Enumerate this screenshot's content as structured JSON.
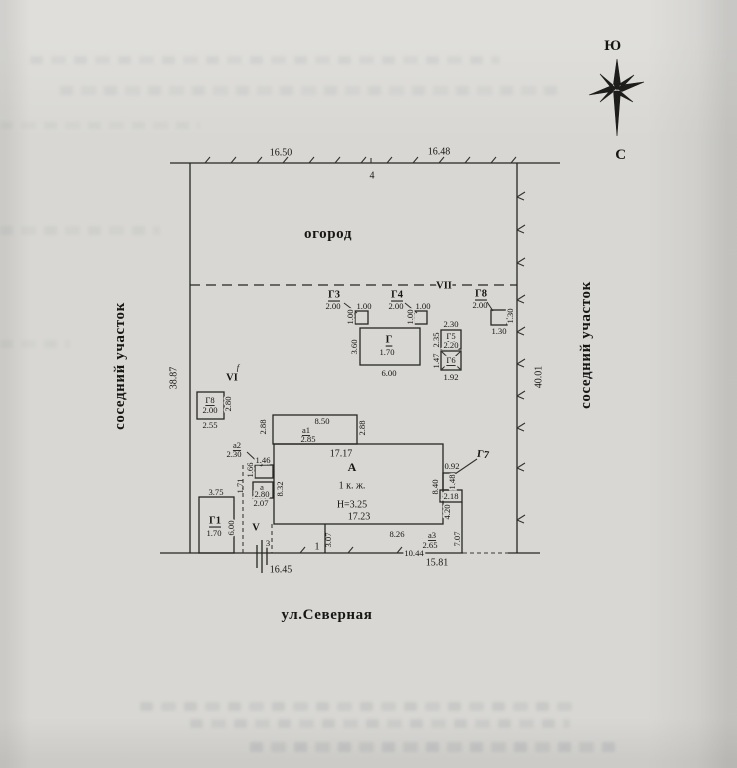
{
  "compass": {
    "south": "Ю",
    "north": "С"
  },
  "plot": {
    "garden_label": "огород",
    "street_label": "ул.Северная",
    "neighbor_left": "соседний участок",
    "neighbor_right": "соседний участок",
    "garden_line_label": "VII",
    "dims": {
      "top_left": "16.50",
      "top_right": "16.48",
      "top_point": "4",
      "left": "38.87",
      "right": "40.01",
      "bottom_left": "16.45",
      "bottom_right": "15.81",
      "gate_point": "3",
      "fence_point": "1"
    }
  },
  "sheds": {
    "g3": {
      "label": "Г3",
      "dist": "2.00",
      "w": "1.00",
      "h": "1.00"
    },
    "g4": {
      "label": "Г4",
      "dist": "2.00",
      "w": "1.00",
      "h": "1.00"
    },
    "g8_fence": {
      "label": "Г8",
      "dist": "2.00",
      "w": "1.30",
      "h": "1.30"
    },
    "g": {
      "label": "Г",
      "area": "1.70",
      "w": "6.00",
      "h": "3.60"
    },
    "g5": {
      "label": "Г5",
      "area": "2.20",
      "w": "2.30",
      "h": "2.35"
    },
    "g6": {
      "label": "Г6",
      "w": "1.92",
      "h": "1.47"
    },
    "g8_left": {
      "label": "Г8",
      "area": "2.00",
      "w": "2.55",
      "h": "2.80"
    },
    "g1": {
      "label": "Г1",
      "area": "1.70",
      "w": "3.75",
      "h": "6.00"
    },
    "g7": {
      "label": "Г7",
      "w": "0.92",
      "h": "1.48",
      "ext": "2.18",
      "side": "4.20"
    },
    "zone_vi": {
      "label": "VI",
      "mark": "f"
    },
    "zone_v": {
      "label": "V"
    }
  },
  "house": {
    "label": "А",
    "storeys": "1 к. ж.",
    "height": "Н=3.25",
    "top": "17.17",
    "bottom": "17.23",
    "left": "8.32",
    "right": "8.40",
    "a1": {
      "label": "a1",
      "w_top": "8.50",
      "w_in": "2.85",
      "left": "2.88",
      "right": "2.88"
    },
    "a2": {
      "label": "a2",
      "dist": "2.30",
      "w": "1.46",
      "h": "1.66",
      "gap": "1.71"
    },
    "a": {
      "label": "a",
      "num": "2.80",
      "w": "2.07"
    },
    "a3": {
      "label": "a3",
      "num": "2.65",
      "top": "8.26",
      "bottom": "10.44",
      "left": "3.07",
      "right": "7.07"
    }
  }
}
